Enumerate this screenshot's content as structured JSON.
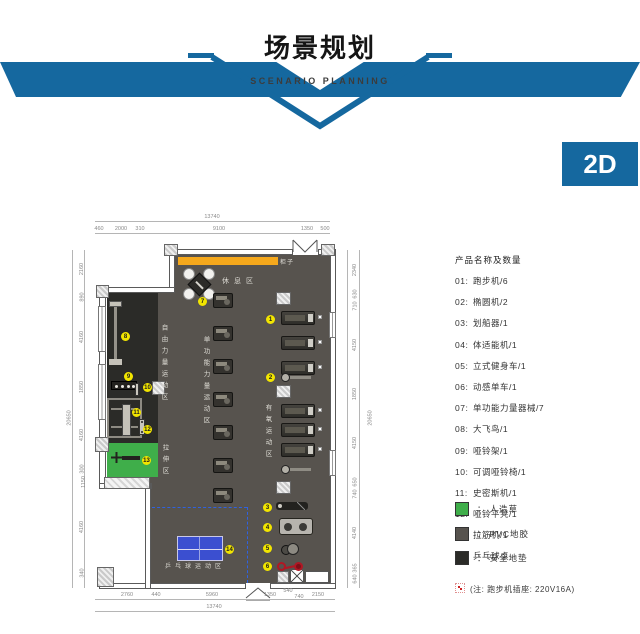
{
  "header": {
    "title": "场景规划",
    "subtitle": "SCENARIO PLANNING",
    "band_color": "#15689f"
  },
  "badge": {
    "label": "2D",
    "bg": "#15689f"
  },
  "plan": {
    "zones": {
      "rest": "休息区",
      "cabinet": "柜子",
      "free_weight": "自由力量运动区",
      "stretch": "拉伸区",
      "single_strength": "单功能力量运动区",
      "aerobic": "有氧运动区",
      "table_tennis": "乒乓球运动区"
    },
    "markers": [
      "1",
      "2",
      "3",
      "4",
      "5",
      "6",
      "7",
      "8",
      "9",
      "10",
      "11",
      "12",
      "13",
      "14"
    ],
    "colors": {
      "pvc_floor": "#57534e",
      "safety_mat": "#2b2b28",
      "grass": "#3fae4a",
      "cabinet_bar": "#f5a81c",
      "tt_table": "#3b4fd0",
      "marker": "#f2e500"
    },
    "dims": {
      "top_total": "13740",
      "top_segments": [
        "460",
        "2000",
        "310",
        "9100",
        "1350",
        "500"
      ],
      "bottom_segments": [
        "2760",
        "440",
        "5960",
        "1350",
        "540",
        "740",
        "2150"
      ],
      "bottom_total": "13740",
      "left_total": "20650",
      "left_segments": [
        "2160",
        "890",
        "4160",
        "1850",
        "4160",
        "300",
        "1150",
        "4160",
        "340"
      ],
      "right_total": "20650",
      "right_segments": [
        "2340",
        "630",
        "710",
        "4150",
        "1850",
        "4150",
        "650",
        "740",
        "4140",
        "365",
        "640"
      ]
    }
  },
  "panel": {
    "title": "产品名称及数量",
    "items": [
      {
        "no": "01:",
        "label": "跑步机/6"
      },
      {
        "no": "02:",
        "label": "椭圆机/2"
      },
      {
        "no": "03:",
        "label": "划船器/1"
      },
      {
        "no": "04:",
        "label": "体适能机/1"
      },
      {
        "no": "05:",
        "label": "立式健身车/1"
      },
      {
        "no": "06:",
        "label": "动感单车/1"
      },
      {
        "no": "07:",
        "label": "单功能力量器械/7"
      },
      {
        "no": "08:",
        "label": "大飞鸟/1"
      },
      {
        "no": "09:",
        "label": "哑铃架/1"
      },
      {
        "no": "10:",
        "label": "可调哑铃椅/1"
      },
      {
        "no": "11:",
        "label": "史密斯机/1"
      },
      {
        "no": "12:",
        "label": "哑铃平凳/1"
      },
      {
        "no": "13:",
        "label": "拉筋机/1"
      },
      {
        "no": "14:",
        "label": "乒乓球桌"
      }
    ],
    "floors": [
      {
        "color": "#3fae4a",
        "colon": "：",
        "label": "人造草"
      },
      {
        "color": "#57534e",
        "colon": "：",
        "label": "PVC地胶"
      },
      {
        "color": "#2b2b28",
        "colon": "：",
        "label": "安全地垫"
      }
    ],
    "note": "(注: 跑步机插座: 220V16A)"
  }
}
